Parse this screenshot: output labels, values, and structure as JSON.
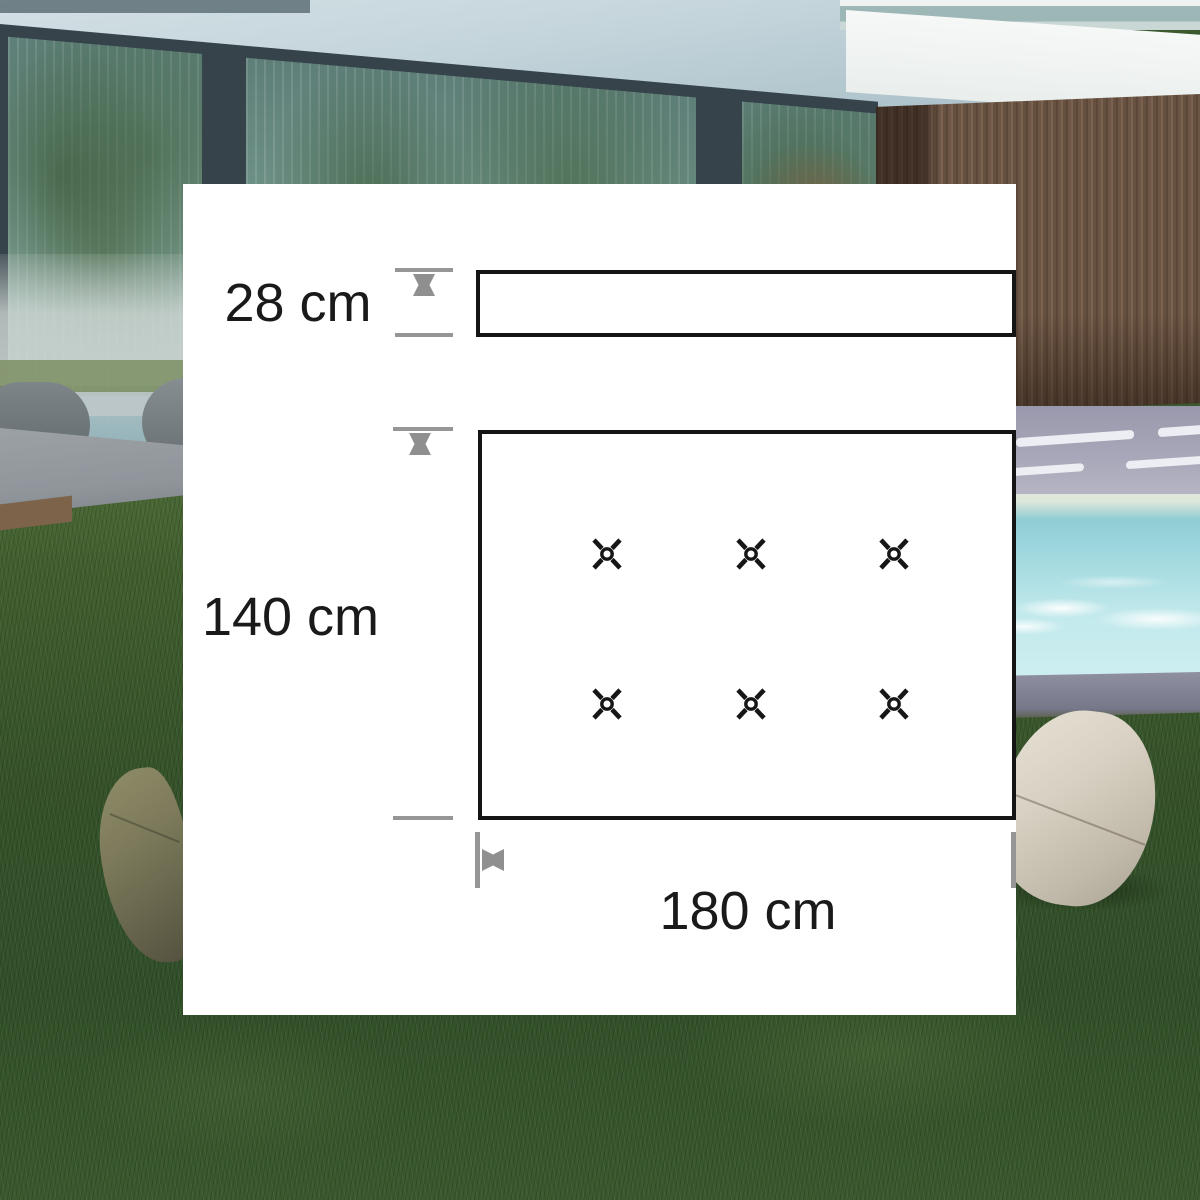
{
  "diagram": {
    "backrest_height_label": "28 cm",
    "seat_height_label": "140 cm",
    "seat_width_label": "180 cm",
    "tuft_buttons": {
      "rows": 2,
      "columns": 3,
      "total": 6
    },
    "colors": {
      "outline": "#141414",
      "dimension_lines": "#8f8f8f",
      "label_text": "#1a1a1a",
      "panel_background": "#ffffff"
    }
  },
  "background_photo": {
    "palette": {
      "grass": "#3a592f",
      "pool_water": "#aadde2",
      "wood_slat_wall": "#6d5546",
      "ceiling_soffit": "#c3d4da",
      "curtain_glass": "#6f9287",
      "terrace": "#a8a7b9",
      "beanbag_left": "#7b795a",
      "beanbag_right": "#d8d1c3"
    }
  }
}
